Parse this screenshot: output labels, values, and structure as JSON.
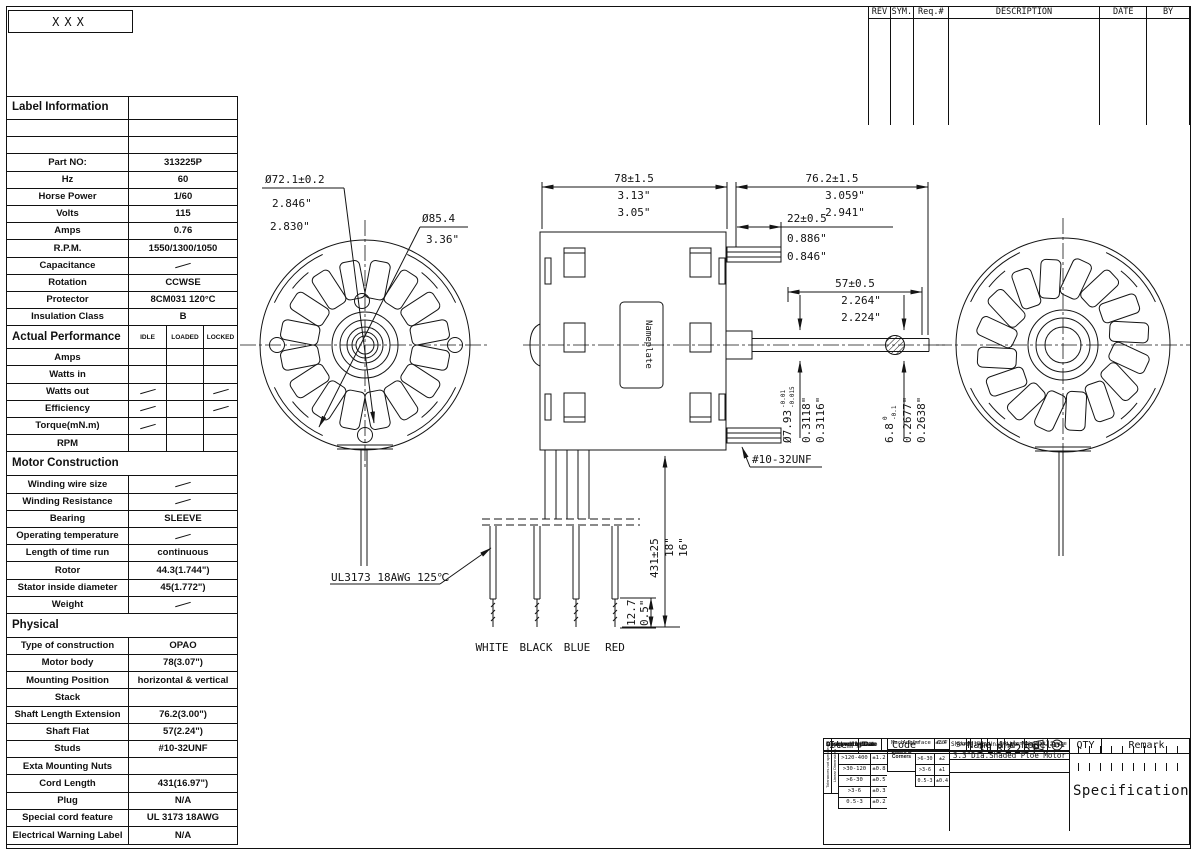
{
  "frame": {
    "corner_label": "XXX"
  },
  "revision_table": {
    "headers": [
      "REV",
      "SYM.",
      "Req.#",
      "DESCRIPTION",
      "DATE",
      "BY"
    ]
  },
  "spec_table": {
    "rows": [
      {
        "t": "sec",
        "l": "Label Information",
        "v": ""
      },
      {
        "t": "r",
        "l": "",
        "v": ""
      },
      {
        "t": "r",
        "l": "",
        "v": ""
      },
      {
        "t": "r",
        "l": "Part NO:",
        "v": "313225P"
      },
      {
        "t": "r",
        "l": "Hz",
        "v": "60"
      },
      {
        "t": "r",
        "l": "Horse Power",
        "v": "1/60"
      },
      {
        "t": "r",
        "l": "Volts",
        "v": "115"
      },
      {
        "t": "r",
        "l": "Amps",
        "v": "0.76"
      },
      {
        "t": "r",
        "l": "R.P.M.",
        "v": "1550/1300/1050"
      },
      {
        "t": "r",
        "l": "Capacitance",
        "v": "~"
      },
      {
        "t": "r",
        "l": "Rotation",
        "v": "CCWSE"
      },
      {
        "t": "r",
        "l": "Protector",
        "v": "8CM031 120°C"
      },
      {
        "t": "r",
        "l": "Insulation Class",
        "v": "B"
      },
      {
        "t": "ph",
        "l": "Actual Performance",
        "c": [
          "IDLE",
          "LOADED",
          "LOCKED"
        ]
      },
      {
        "t": "p3",
        "l": "Amps",
        "c": [
          "",
          "",
          ""
        ]
      },
      {
        "t": "p3",
        "l": "Watts in",
        "c": [
          "",
          "",
          ""
        ]
      },
      {
        "t": "p3",
        "l": "Watts out",
        "c": [
          "~",
          "",
          "~"
        ]
      },
      {
        "t": "p3",
        "l": "Efficiency",
        "c": [
          "~",
          "",
          "~"
        ]
      },
      {
        "t": "p3",
        "l": "Torque(mN.m)",
        "c": [
          "~",
          "",
          ""
        ]
      },
      {
        "t": "p3",
        "l": "RPM",
        "c": [
          "",
          "",
          ""
        ]
      },
      {
        "t": "sec2",
        "l": "Motor Construction",
        "v": ""
      },
      {
        "t": "r",
        "l": "Winding wire size",
        "v": "~"
      },
      {
        "t": "r",
        "l": "Winding Resistance",
        "v": "~"
      },
      {
        "t": "r",
        "l": "Bearing",
        "v": "SLEEVE"
      },
      {
        "t": "r",
        "l": "Operating temperature",
        "v": "~"
      },
      {
        "t": "r",
        "l": "Length of time run",
        "v": "continuous"
      },
      {
        "t": "r",
        "l": "Rotor",
        "v": "44.3(1.744\")"
      },
      {
        "t": "r",
        "l": "Stator inside diameter",
        "v": "45(1.772\")"
      },
      {
        "t": "r",
        "l": "Weight",
        "v": "~"
      },
      {
        "t": "sec2",
        "l": "Physical",
        "v": ""
      },
      {
        "t": "r",
        "l": "Type of construction",
        "v": "OPAO"
      },
      {
        "t": "r",
        "l": "Motor body",
        "v": "78(3.07\")"
      },
      {
        "t": "r",
        "l": "Mounting Position",
        "v": "horizontal & vertical"
      },
      {
        "t": "r",
        "l": "Stack",
        "v": ""
      },
      {
        "t": "r",
        "l": "Shaft Length Extension",
        "v": "76.2(3.00\")"
      },
      {
        "t": "r",
        "l": "Shaft Flat",
        "v": "57(2.24\")"
      },
      {
        "t": "r",
        "l": "Studs",
        "v": "#10-32UNF"
      },
      {
        "t": "r",
        "l": "Exta Mounting Nuts",
        "v": ""
      },
      {
        "t": "r",
        "l": "Cord Length",
        "v": "431(16.97\")"
      },
      {
        "t": "r",
        "l": "Plug",
        "v": "N/A"
      },
      {
        "t": "r",
        "l": "Special cord feature",
        "v": "UL 3173 18AWG"
      },
      {
        "t": "r",
        "l": "Electrical Warning Label",
        "v": "N/A"
      }
    ]
  },
  "drawing": {
    "front": {
      "d1a": "Ø72.1±0.2",
      "d1b": "2.846\"",
      "d1c": "2.830\"",
      "d2a": "Ø85.4",
      "d2b": "3.36\""
    },
    "dims": {
      "body": [
        "78±1.5",
        "3.13\"",
        "3.05\""
      ],
      "ext": [
        "76.2±1.5",
        "3.059\"",
        "2.941\""
      ],
      "stud": [
        "22±0.5",
        "0.886\"",
        "0.846\""
      ],
      "flat": [
        "57±0.5",
        "2.264\"",
        "2.224\""
      ],
      "sdia": {
        "mm": "Ø7.93",
        "t1": "-0.01",
        "t2": "-0.015",
        "i1": "0.3118\"",
        "i2": "0.3116\""
      },
      "fdia": {
        "mm": "6.8",
        "t1": "0",
        "t2": "-0.1",
        "i1": "0.2677\"",
        "i2": "0.2638\""
      },
      "cord": [
        "431±25",
        "18\"",
        "16\""
      ],
      "strip": [
        "12.7",
        "0.5\""
      ]
    },
    "labels": {
      "thread": "#10-32UNF",
      "wire_spec": "UL3173 18AWG 125℃",
      "nameplate": "Nameplate"
    },
    "wires": [
      "WHITE",
      "BLACK",
      "BLUE",
      "RED"
    ]
  },
  "title_block": {
    "headers": [
      "Item",
      "Code",
      "Name and Model",
      "QTY",
      "Remark"
    ],
    "tol": {
      "rot1": "Tolerances not specified",
      "rot2": "Linear Dimensions",
      "rows": [
        [
          ">120-400",
          "±1.2"
        ],
        [
          ">30-120",
          "±0.8"
        ],
        [
          ">6-30",
          "±0.5"
        ],
        [
          ">3-6",
          "±0.3"
        ],
        [
          "0.5-3",
          "±0.2"
        ]
      ],
      "edges": "Edges & Corners",
      "erows": [
        [
          ">6-30",
          "±2"
        ],
        [
          ">3-6",
          "±1"
        ],
        [
          "0.5-3",
          "±0.4"
        ]
      ],
      "mach": [
        "Mach.Surface",
        "6.4"
      ],
      "angle": [
        "Angle",
        "±30'"
      ]
    },
    "name": "3.3\"Dia.Shaded Ploe Motor",
    "model": "313225P",
    "spec": "Specification",
    "sign": [
      "Designed by/Date",
      "Checked by/Date",
      "Approved by/Date"
    ],
    "stage": {
      "h": [
        "Stage Sign",
        "Edition",
        "Weight",
        "Scale"
      ],
      "v": [
        "S",
        "A",
        "1:1"
      ],
      "sheet": [
        "Sheet",
        "1/1",
        "Unit",
        "mm"
      ]
    }
  }
}
